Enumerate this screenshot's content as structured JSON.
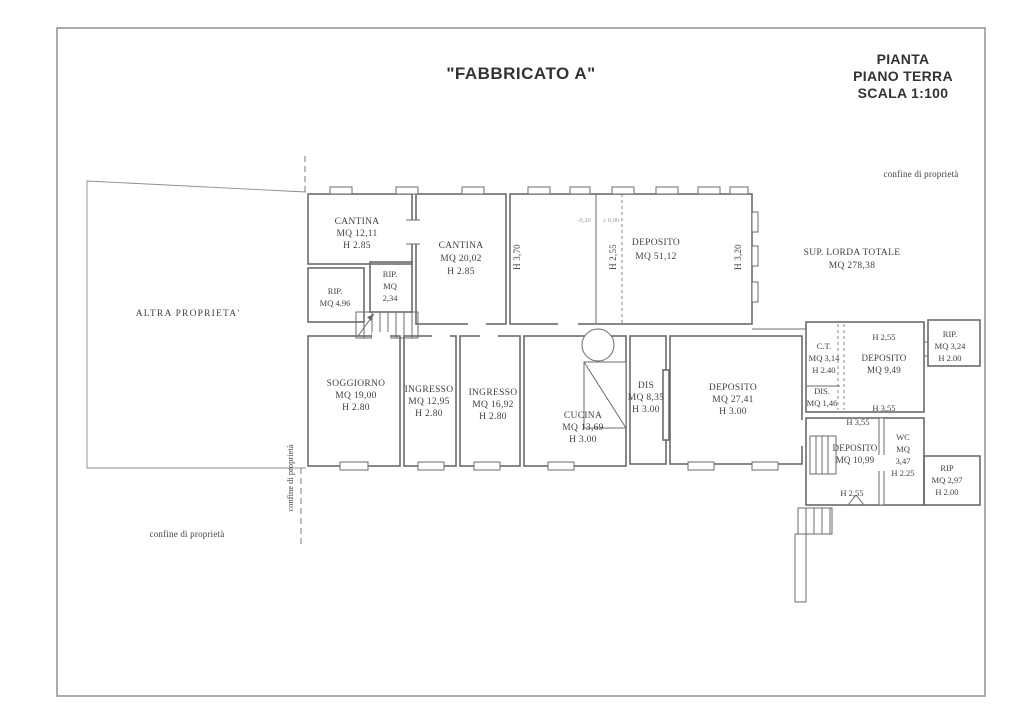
{
  "header": {
    "building_title": "\"FABBRICATO A\"",
    "plan_title_line1": "PIANTA",
    "plan_title_line2": "PIANO TERRA",
    "plan_title_line3": "SCALA 1:100"
  },
  "annotations": {
    "boundary_top_right": "confine di proprietà",
    "boundary_bottom_left": "confine di proprietà",
    "boundary_vertical": "confine di proprietà",
    "other_property": "ALTRA PROPRIETA'",
    "gross_area_line1": "SUP. LORDA TOTALE",
    "gross_area_line2": "MQ 278,38",
    "level_mark_left": "-0,20",
    "level_mark_right": "± 0,00"
  },
  "rooms": {
    "cantina_small": {
      "name": "CANTINA",
      "area": "MQ 12,11",
      "height": "H 2.85"
    },
    "cantina_large": {
      "name": "CANTINA",
      "area": "MQ 20,02",
      "height": "H 2.85"
    },
    "rip_496": {
      "name": "RIP.",
      "area": "MQ 4,96"
    },
    "rip_234": {
      "name": "RIP.",
      "area_label": "MQ",
      "area_value": "2,34"
    },
    "deposito_5112": {
      "name": "DEPOSITO",
      "area": "MQ 51,12"
    },
    "soggiorno": {
      "name": "SOGGIORNO",
      "area": "MQ 19,00",
      "height": "H 2.80"
    },
    "ingresso_1295": {
      "name": "INGRESSO",
      "area": "MQ 12,95",
      "height": "H 2.80"
    },
    "ingresso_1692": {
      "name": "INGRESSO",
      "area": "MQ 16,92",
      "height": "H 2.80"
    },
    "cucina": {
      "name": "CUCINA",
      "area": "MQ 13,69",
      "height": "H 3.00"
    },
    "dis_835": {
      "name": "DIS",
      "area": "MQ 8,35",
      "height": "H 3.00"
    },
    "deposito_2741": {
      "name": "DEPOSITO",
      "area": "MQ 27,41",
      "height": "H 3.00"
    },
    "ct": {
      "name": "C.T.",
      "area": "MQ 3,14",
      "height": "H 2.40"
    },
    "deposito_949": {
      "name": "DEPOSITO",
      "area": "MQ 9,49"
    },
    "rip_324": {
      "name": "RIP.",
      "area": "MQ 3,24",
      "height": "H 2.00"
    },
    "dis_146": {
      "name": "DIS.",
      "area": "MQ 1,46"
    },
    "deposito_1099": {
      "name": "DEPOSITO",
      "area": "MQ 10,99"
    },
    "wc": {
      "name": "WC",
      "area_label": "MQ",
      "area_value": "3,47",
      "height": "H 2.25"
    },
    "rip_297": {
      "name": "RIP",
      "area": "MQ 2,97",
      "height": "H 2.00"
    }
  },
  "wall_heights": {
    "h_370": "H 3,70",
    "h_255_top": "H 2,55",
    "h_320": "H 3,20",
    "h_255_dep949": "H 2,55",
    "h_355_upper": "H 3,55",
    "h_355_lower": "H 3,55",
    "h_255_bottom": "H 2,55"
  },
  "colors": {
    "wall_line": "#6b6b6b",
    "text": "#3f3f3f",
    "page_border": "#909090"
  }
}
